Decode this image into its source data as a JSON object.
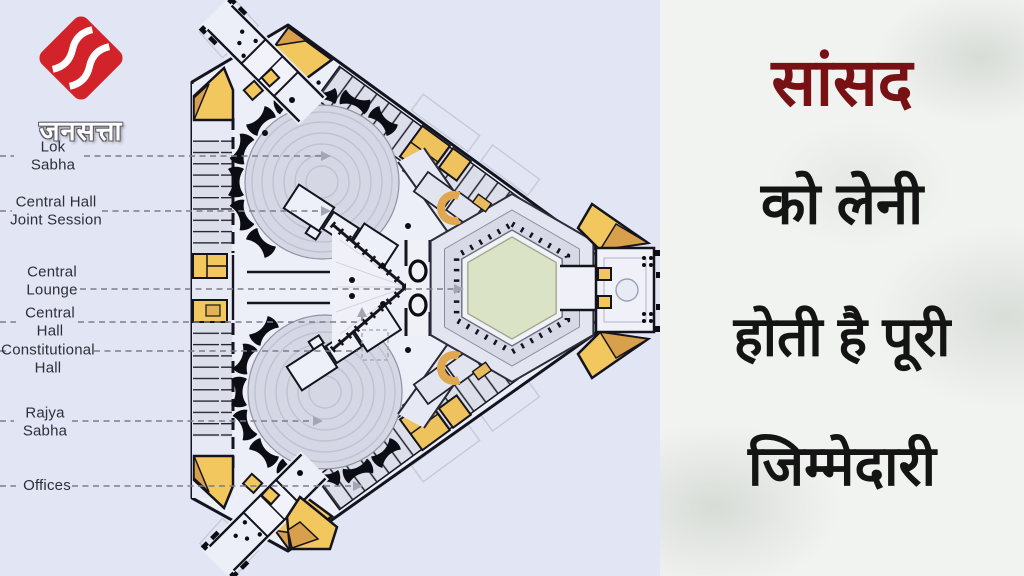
{
  "brand": {
    "name": "जनसत्ता"
  },
  "headline": {
    "lines": [
      "सांसद",
      "को लेनी",
      "होती है पूरी",
      "जिम्मेदारी"
    ]
  },
  "plan": {
    "title_semantic": "New Parliament building floor plan",
    "labels": [
      {
        "text": "Lok\nSabha"
      },
      {
        "text": "Central Hall\nJoint Session"
      },
      {
        "text": "Central\nLounge"
      },
      {
        "text": "Central\nHall"
      },
      {
        "text": "Constitutional\nHall"
      },
      {
        "text": "Rajya\nSabha"
      },
      {
        "text": "Offices"
      }
    ]
  },
  "colors": {
    "plan_background": "#e1e5f4",
    "panel_background": "#f1f3f0",
    "headline_red": "#781114",
    "headline_black": "#141414",
    "logo_red": "#d2232a",
    "plan_yellow": "#f1c75e",
    "plan_tan": "#d9a04c",
    "courtyard_green": "#dbe3c6",
    "wall": "#14141e"
  }
}
